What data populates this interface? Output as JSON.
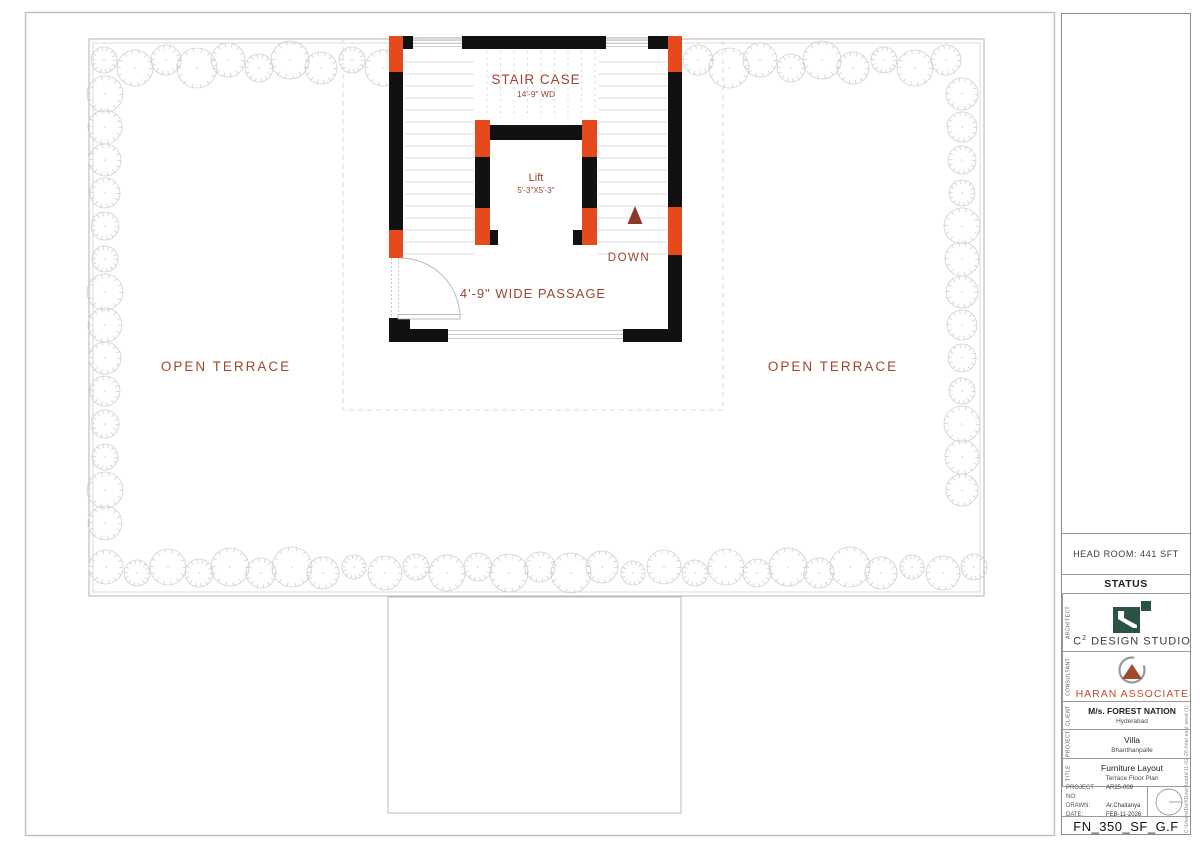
{
  "colors": {
    "wall_black": "#111111",
    "column_orange": "#e5491c",
    "plan_text_maroon": "#9d4433",
    "brand_red": "#bf4b32",
    "logo_green": "#2a5245"
  },
  "plan": {
    "staircase": {
      "label": "STAIR CASE",
      "width": "14'-9\" WD"
    },
    "lift": {
      "label": "Lift",
      "size": "5'-3\"X5'-3\""
    },
    "down_label": "DOWN",
    "passage_label": "4'-9\" WIDE PASSAGE",
    "terrace_left_label": "OPEN TERRACE",
    "terrace_right_label": "OPEN TERRACE"
  },
  "title_block": {
    "head_room": "HEAD ROOM: 441 SFT",
    "status": "STATUS",
    "architect": {
      "section_label": "ARCHITECT",
      "brand_c": "C",
      "brand_sup": "2",
      "brand_rest": " DESIGN STUDIO"
    },
    "consultant": {
      "section_label": "CONSULTANT",
      "name": "CHARAN ASSOCIATES"
    },
    "client": {
      "section_label": "CLIENT",
      "name": "M/s. FOREST NATION",
      "city": "Hyderabad"
    },
    "project": {
      "section_label": "PROJECT",
      "name": "Villa",
      "location": "Bhanthanpalle"
    },
    "title": {
      "section_label": "TITLE",
      "name": "Furniture Layout",
      "subtitle": "Terrace Floor Plan"
    },
    "info": {
      "rows": [
        {
          "label": "PROJECT NO:",
          "value": "AR25-009"
        },
        {
          "label": "DRAWN:",
          "value": "Ar.Chaitanya"
        },
        {
          "label": "DATE:",
          "value": "FEB-11-2026"
        }
      ]
    },
    "drawing_number": "FN_350_SF_G.F",
    "file_path": "C:\\Users\\Dell\\Downloads\\11-02-26-final east west (1)"
  }
}
